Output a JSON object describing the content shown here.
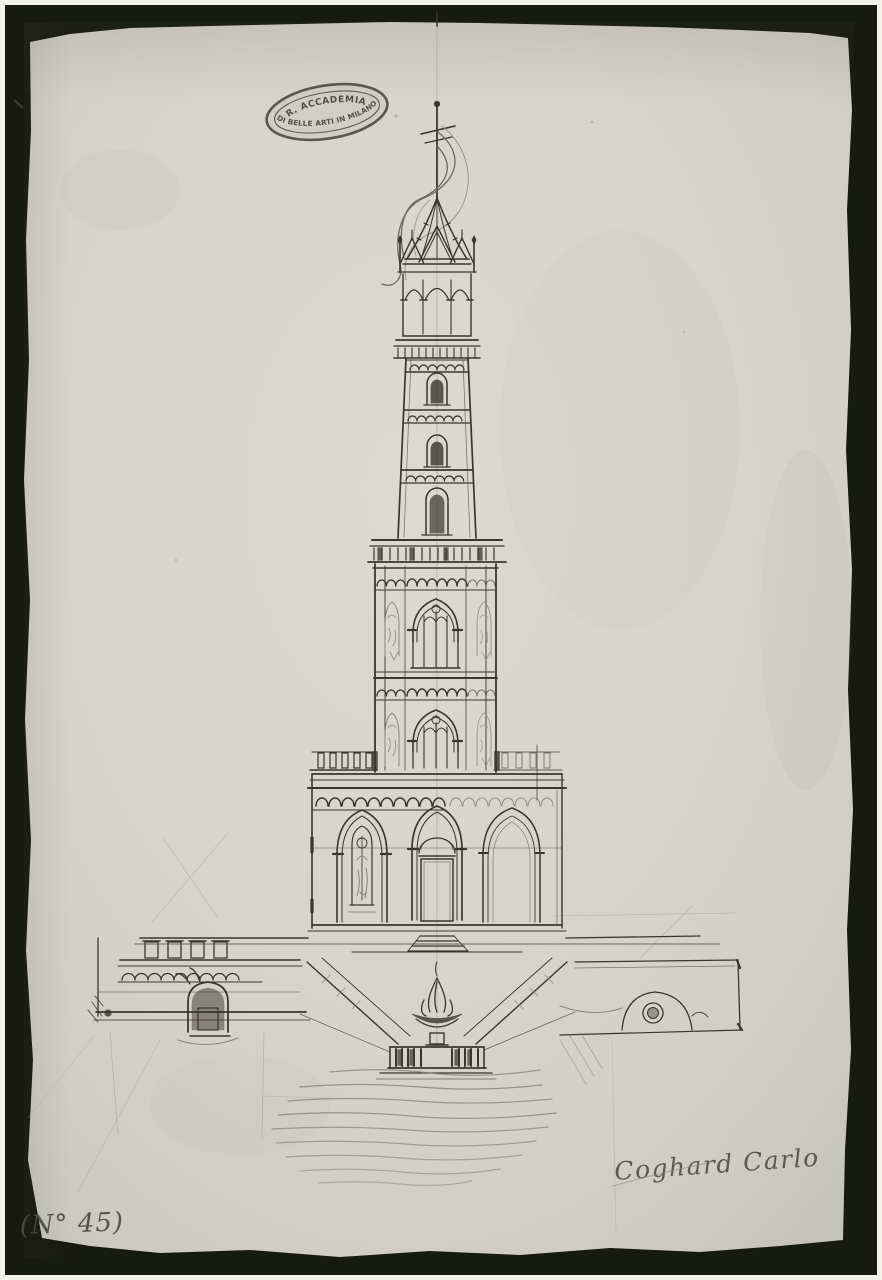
{
  "artifact": {
    "kind": "scanned architectural drawing of a gothic tower",
    "stamp": {
      "line_top": "R. ACCADEMIA",
      "line_bottom": "DI BELLE ARTI IN MILANO"
    },
    "signature": "Coghard Carlo",
    "inventory_number": "(N° 45)",
    "colors": {
      "mat": "#f4f2ed",
      "photo_border": "#171a12",
      "paper": "#d7d4cd",
      "ink": "#3a362f",
      "pencil": "#8b867c",
      "stamp_ink": "#45413a"
    }
  }
}
